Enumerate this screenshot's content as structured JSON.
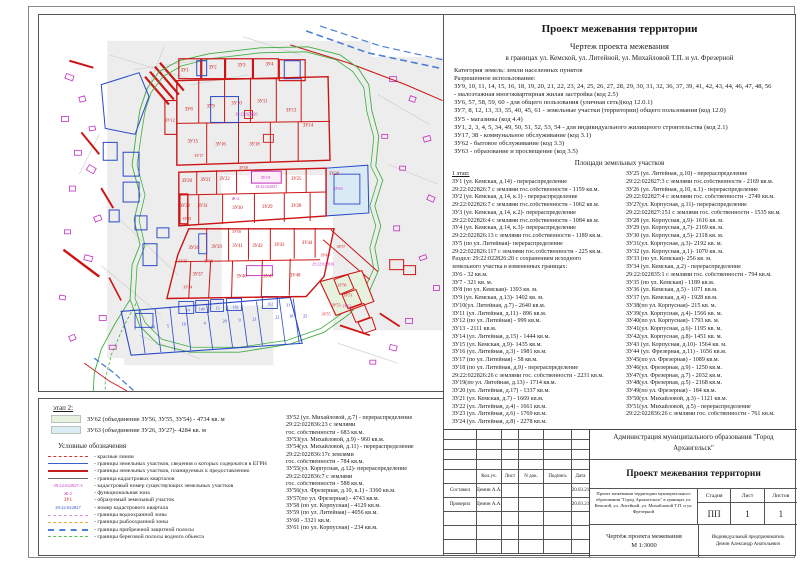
{
  "right_panel": {
    "title": "Проект межевания территории",
    "subtitle": "Чертеж проекта межевания",
    "boundary_line": "в границах ул. Кемской, ул. Литейной, ул. Михайловой Т.П. и ул. Фрезерной",
    "paragraph_lines": [
      "Категория земель: земли населенных пунктов",
      "Разрешенное использование:",
      "ЗУ9, 10, 11, 14, 15, 16, 18, 19, 20, 21, 22, 23, 24, 25, 26, 27, 28, 29, 30, 31, 32, 36, 37, 39, 41, 42, 43, 44, 46, 47, 48, 56",
      "- малоэтажная многоквартирная жилая застройка (код 2.5)",
      "ЗУ6, 57, 58, 59, 60 - для общего пользования (уличная сеть)(код 12.0.1)",
      "ЗУ7, 8, 12, 13, 33, 35, 40, 45, 61 - земельные участки (территории) общего пользования (код 12.0)",
      "ЗУ5 - магазины (код 4.4)",
      "ЗУ1, 2, 3, 4, 5, 34, 49, 50, 51, 52, 53, 54 - для индивидуального жилищного строительства (код 2.1)",
      "ЗУ17, 38 - коммунальное обслуживание (код 3.1)",
      "ЗУ62 - бытовое  обслуживание (код 3.3)",
      "ЗУ63 - образование и просвещение (код 3.5)"
    ],
    "areas_heading": "Площади земельных участков",
    "stage1_label": "1 этап:",
    "areas_col1": [
      "ЗУ1 (ул. Кемская, д.14) - перераспределение",
      "29:22:022826:7 с землями гос.собственности - 1159 кв.м.",
      "ЗУ2 (ул. Кемская, д.14, к.1) - перераспределение",
      "29:22:022826:7 с землями гос.собственности - 1062 кв.м.",
      "ЗУ3 (ул. Кемская, д.14, к.2)- перераспределение",
      "29:22:022826:4 с землями гос.собственности - 1084 кв.м.",
      "ЗУ4 (ул. Кемская, д.14, к.3)- перераспределение",
      "29:22:022826:13 с землями гос.собственности - 1189 кв.м.",
      "ЗУ5 (по ул. Литейная)- перераспределение",
      "29:22:022826:117 с землями гос.собственности - 225 кв.м.",
      "Раздел: 29:22:022826:20 с сохранением исходного",
      "земельного участка в измененных границах:",
      "ЗУ6 - 32 кв.м.",
      "ЗУ7 - 321 кв. м.",
      "ЗУ8 (по ул. Кемская)- 1393 кв. м.",
      "ЗУ9 (ул. Кемская, д.13)- 1402 кв. м.",
      "ЗУ10(ул. Литейная, д.7) - 2640 кв.м.",
      "ЗУ11  (ул. Литейная, д.11) - 896 кв.м.",
      "ЗУ12 (по ул. Литейная) - 999 кв.м.",
      "ЗУ13 - 2111 кв.м.",
      "ЗУ14 (ул. Литейная, д.15) - 1444 кв.м.",
      "ЗУ15 (ул. Кемская, д.9)- 1435 кв.м.",
      "ЗУ16 (ул. Литейная, д.3) - 1981 кв.м.",
      "ЗУ17 (по ул. Литейная) - 58 кв.м.",
      "ЗУ18 (по ул. Литейная, д.9) - перераспределение",
      "29:22:022826:26 с землями гос. собственности - 2231 кв.м.",
      "ЗУ19(по ул. Литейная, д.13) - 1714 кв.м.",
      "ЗУ20 (ул. Литейная, д.17) - 1337 кв.м.",
      "ЗУ21 (ул. Кемская, д.7) - 1669 кв.м.",
      "ЗУ22 (ул. Литейная, д.4) - 1661 кв.м.",
      "ЗУ23 (ул. Литейная, д.6) - 1769 кв.м.",
      "ЗУ24 (ул. Литейная, д.8) - 2278 кв.м."
    ],
    "areas_col2": [
      "ЗУ25 (ул. Литейная, д.10) - перераспределение",
      "29:22:022827:3 с землями гос.собственности - 2169 кв.м.",
      "ЗУ26 (ул. Литейная, д.10, к.1) - перераспределение",
      "29:22:022827:4 с землями гос. собственности - 2749 кв.м.",
      "ЗУ27(ул. Корпусная, д.11)- перераспределение",
      "29:22:022827:151 с землями гос. собственности - 1535 кв.м.",
      "ЗУ28  (ул. Корпусная, д.9)- 1616 кв. м.",
      "ЗУ29 (ул. Корпусная, д.7)- 2169 кв. м.",
      "ЗУ30 (ул. Корпусная, д.5)- 2118 кв. м.",
      "ЗУ31(ул. Корпусная, д.3)- 2192 кв. м.",
      "ЗУ32 (ул. Корпусная, д.1)- 1070 кв. м.",
      "ЗУ33 (по ул. Кемская)- 256 кв. м.",
      "ЗУ34 (ул. Кемская, д.2) - перераспределение",
      "29:22:022835:1 с землями гос. собственности - 794 кв.м.",
      "ЗУ35 (по ул. Кемская) - 1189 кв.м.",
      "ЗУ36 (ул. Кемская, д.5) - 1071 кв.м.",
      "ЗУ37 (ул. Кемская, д.4) - 1928 кв.м.",
      "ЗУ38(по ул. Корпусная)- 215 кв. м.",
      "ЗУ39(ул. Корпусная, д.4)- 1566 кв. м.",
      "ЗУ40(по ул. Корпусная)- 1793 кв. м.",
      "ЗУ41(ул. Корпусная, д.6)- 1195 кв. м.",
      "ЗУ42(ул. Корпусная, д.8)- 1451 кв. м.",
      "ЗУ43 (ул. Корпусная, д.10)- 1564 кв. м.",
      "ЗУ44 (ул. Фрезерная, д.11) - 1656 кв.м.",
      "ЗУ45(по ул. Фрезерная) - 1089 кв.м.",
      "ЗУ46(ул. Фрезерная, д.9) - 1250 кв.м.",
      "ЗУ47(ул. Фрезерная, д.7) - 2032 кв.м.",
      "ЗУ48(ул. Фрезерная, д.5) - 2168 кв.м.",
      "ЗУ49(по ул. Фрезерная) - 184 кв.м.",
      "ЗУ50(ул. Михайловой, д.3) - 1121 кв.м.",
      "ЗУ51(ул. Михайловой, д.5) - перераспределение",
      "29:22:022836:26 с землями гос. собственности - 761 кв.м."
    ]
  },
  "bottom_panel": {
    "stage2_label": "этап 2:",
    "stage2_items": [
      {
        "swatch": "#e7f2de",
        "text": "ЗУ62 (объединение ЗУ56, ЗУ55, ЗУ54) - 4734 кв. м"
      },
      {
        "swatch": "#dcecf4",
        "text": "ЗУ63 (объединение ЗУ26, ЗУ27)- 4284 кв. м"
      }
    ],
    "legend_title": "Условные обозначения",
    "legend": [
      {
        "type": "line",
        "style": "red-dash",
        "label": "- красные линии"
      },
      {
        "type": "line",
        "style": "blue-solid",
        "label": "- границы земельных участков, сведения о которых содержатся в ЕГРН"
      },
      {
        "type": "line",
        "style": "red-thick",
        "label": "- границы земельных участков, планируемых к предоставлению"
      },
      {
        "type": "line",
        "style": "black-thin",
        "label": "- граница кадастровых кварталов"
      },
      {
        "type": "text",
        "style": "m",
        "sample": "29:22:022827:3",
        "label": "- кадастровый номер существующих земельных участков"
      },
      {
        "type": "text",
        "style": "m",
        "sample": "Ж-2",
        "label": "- функциональная зона"
      },
      {
        "type": "text",
        "style": "r",
        "sample": "ЗУ1",
        "label": "- образуемый земельный участок"
      },
      {
        "type": "text",
        "style": "b",
        "sample": "29:22:022827",
        "label": "- номер кадастрового квартала"
      },
      {
        "type": "line",
        "style": "magenta-dash",
        "label": "- границы водоохранной зоны"
      },
      {
        "type": "line",
        "style": "orange-dash",
        "label": "- границы рыбоохранной зоны"
      },
      {
        "type": "line",
        "style": "blue-dash",
        "label": "- границы прибрежной защитной полосы"
      },
      {
        "type": "line",
        "style": "green-dash",
        "label": "- границы береговой полосы водного объекта"
      }
    ],
    "areas_col3": [
      "ЗУ52 (ул. Михайловой, д.7) - перераспределение",
      "29:22:022836:23 с землями",
      "гос. собственности - 683 кв.м.",
      "ЗУ53(ул. Михайловой, д.9) - 960 кв.м.",
      "ЗУ54(ул. Михайловой, д.11) - перераспределение",
      "29:22:022836:17с землями",
      "гос. собственности - 784 кв.м.",
      "ЗУ55(ул. Корпусная, д.12)- перераспределение",
      "29:22:022836:7 с землями",
      "гос. собственности - 588 кв.м.",
      "ЗУ56(ул. Фрезерная, д.10, к.1) - 3360 кв.м.",
      "ЗУ57(по ул. Фрезерная) - 4743 кв.м.",
      "ЗУ58 (по ул. Корпусная) - 4129 кв.м.",
      "ЗУ59 (по ул. Литейная) - 4056 кв.м.",
      "ЗУ60 - 3321 кв.м.",
      "ЗУ61 (по ул. Корпусная) - 234 кв.м."
    ]
  },
  "title_block": {
    "header_cols": [
      "Кол.уч.",
      "Лист",
      "N док.",
      "Подпись",
      "Дата"
    ],
    "rows": [
      {
        "role": "Составил",
        "name": "Демин А.А.",
        "date": "20.03.21"
      },
      {
        "role": "Проверил",
        "name": "Демин А.А.",
        "date": "20.03.21"
      }
    ],
    "org": "Администрация муниципального образования \"Город Архангельск\"",
    "doc_title": "Проект межевания территории",
    "project_desc": "Проект межевания территории муниципального образования \"Город Архангельск\" в границах ул. Кемской, ул. Литейной, ул. Михайловой Т.П. и ул. Фрезерной",
    "stage_label": "Стадия",
    "sheet_label": "Лист",
    "sheets_label": "Листов",
    "stage_value": "ПП",
    "sheet_value": "1",
    "sheets_value": "1",
    "drawing_name": "Чертёж проекта межевания",
    "scale": "М 1:3000",
    "contractor": "Индивидуальный предприниматель",
    "contractor_name": "Демин Александр Анатольевич"
  },
  "map": {
    "colors": {
      "red": "#cc1414",
      "blue": "#2a48c8",
      "magenta": "#c02ec0",
      "green": "#3fae3f",
      "orange": "#e8a23c",
      "grey": "#cfcfcf"
    },
    "labels": [
      {
        "t": "ЗУ1",
        "x": 146,
        "y": 57
      },
      {
        "t": "ЗУ2",
        "x": 174,
        "y": 54
      },
      {
        "t": "ЗУ3",
        "x": 203,
        "y": 52
      },
      {
        "t": "ЗУ4",
        "x": 231,
        "y": 51
      },
      {
        "t": "ЗУ8",
        "x": 150,
        "y": 96
      },
      {
        "t": "ЗУ9",
        "x": 172,
        "y": 93
      },
      {
        "t": "ЗУ10",
        "x": 198,
        "y": 90
      },
      {
        "t": "ЗУ11",
        "x": 224,
        "y": 88
      },
      {
        "t": "ЗУ13",
        "x": 253,
        "y": 97
      },
      {
        "t": "ЗУ14",
        "x": 270,
        "y": 112
      },
      {
        "t": "ЗУ12",
        "x": 131,
        "y": 107,
        "s": 4.4
      },
      {
        "t": "ЗУ15",
        "x": 154,
        "y": 128
      },
      {
        "t": "ЗУ16",
        "x": 182,
        "y": 131
      },
      {
        "t": "ЗУ18",
        "x": 216,
        "y": 131
      },
      {
        "t": "ЗУ17",
        "x": 160,
        "y": 143,
        "s": 4
      },
      {
        "t": "29:22:022826",
        "x": 208,
        "y": 101,
        "c": "m",
        "s": 4
      },
      {
        "t": "ЗУ59",
        "x": 205,
        "y": 155,
        "s": 4
      },
      {
        "t": "ЗУ20",
        "x": 148,
        "y": 168
      },
      {
        "t": "ЗУ21",
        "x": 167,
        "y": 167
      },
      {
        "t": "ЗУ22",
        "x": 186,
        "y": 166
      },
      {
        "t": "ЗУ19",
        "x": 227,
        "y": 165,
        "c": "m",
        "s": 4.4
      },
      {
        "t": "29:22:022827",
        "x": 228,
        "y": 174,
        "c": "m",
        "s": 4
      },
      {
        "t": "ЗУ25",
        "x": 258,
        "y": 166
      },
      {
        "t": "ЗУ26",
        "x": 296,
        "y": 161
      },
      {
        "t": "ЗУ63",
        "x": 300,
        "y": 176,
        "c": "m",
        "s": 4.4
      },
      {
        "t": "Ж-2",
        "x": 197,
        "y": 186,
        "c": "m",
        "s": 4.6
      },
      {
        "t": "ЗУ32",
        "x": 146,
        "y": 193
      },
      {
        "t": "ЗУ31",
        "x": 164,
        "y": 193
      },
      {
        "t": "ЗУ30",
        "x": 199,
        "y": 195
      },
      {
        "t": "ЗУ29",
        "x": 229,
        "y": 194
      },
      {
        "t": "ЗУ28",
        "x": 258,
        "y": 193
      },
      {
        "t": "ЗУ33",
        "x": 148,
        "y": 206,
        "s": 4
      },
      {
        "t": "ЗУ58",
        "x": 198,
        "y": 219,
        "s": 4
      },
      {
        "t": "ЗУ36",
        "x": 155,
        "y": 235
      },
      {
        "t": "ЗУ39",
        "x": 178,
        "y": 234
      },
      {
        "t": "ЗУ41",
        "x": 199,
        "y": 233
      },
      {
        "t": "ЗУ42",
        "x": 219,
        "y": 233
      },
      {
        "t": "ЗУ43",
        "x": 241,
        "y": 232
      },
      {
        "t": "ЗУ44",
        "x": 269,
        "y": 230
      },
      {
        "t": "ЗУ45",
        "x": 287,
        "y": 243,
        "s": 4.2
      },
      {
        "t": "ЗУ35",
        "x": 144,
        "y": 249,
        "s": 4.2
      },
      {
        "t": "ЗУ38",
        "x": 170,
        "y": 249,
        "s": 4.2
      },
      {
        "t": "ЗУ37",
        "x": 159,
        "y": 262
      },
      {
        "t": "ЗУ46",
        "x": 203,
        "y": 264
      },
      {
        "t": "ЗУ47",
        "x": 230,
        "y": 264
      },
      {
        "t": "ЗУ48",
        "x": 257,
        "y": 263
      },
      {
        "t": "ЗУ34",
        "x": 149,
        "y": 275,
        "s": 4.2
      },
      {
        "t": "29:22:022836",
        "x": 285,
        "y": 252,
        "c": "m",
        "s": 4
      },
      {
        "t": "ЗУ57",
        "x": 303,
        "y": 234,
        "s": 4
      },
      {
        "t": "ЗУ50",
        "x": 304,
        "y": 273,
        "s": 4.2
      },
      {
        "t": "ЗУ51",
        "x": 310,
        "y": 283,
        "s": 4.2
      },
      {
        "t": "ЗУ53",
        "x": 298,
        "y": 293,
        "s": 4.2
      },
      {
        "t": "ЗУ55",
        "x": 288,
        "y": 302,
        "s": 4.2
      },
      {
        "t": "ЗУ62",
        "x": 309,
        "y": 294,
        "c": "m",
        "s": 4.2
      },
      {
        "t": "3",
        "x": 96,
        "y": 316,
        "c": "b",
        "s": 4.2
      },
      {
        "t": "13",
        "x": 114,
        "y": 315,
        "c": "b",
        "s": 4.2
      },
      {
        "t": "5",
        "x": 129,
        "y": 314,
        "c": "b",
        "s": 4.2
      },
      {
        "t": "16",
        "x": 145,
        "y": 312,
        "c": "b",
        "s": 4.2
      },
      {
        "t": "4",
        "x": 166,
        "y": 311,
        "c": "b",
        "s": 4.2
      },
      {
        "t": "20",
        "x": 186,
        "y": 309,
        "c": "b",
        "s": 4.2
      },
      {
        "t": "9",
        "x": 201,
        "y": 308,
        "c": "b",
        "s": 4.2
      },
      {
        "t": "21",
        "x": 216,
        "y": 307,
        "c": "b",
        "s": 4.2
      },
      {
        "t": "22",
        "x": 239,
        "y": 305,
        "c": "b",
        "s": 4.2
      },
      {
        "t": "18",
        "x": 253,
        "y": 304,
        "c": "b",
        "s": 4.2
      },
      {
        "t": "25",
        "x": 267,
        "y": 304,
        "c": "b",
        "s": 4.2
      },
      {
        "t": "31",
        "x": 250,
        "y": 293,
        "c": "b",
        "s": 4.2
      },
      {
        "t": "163",
        "x": 197,
        "y": 295,
        "c": "b",
        "s": 3.8
      },
      {
        "t": "162",
        "x": 232,
        "y": 292,
        "c": "b",
        "s": 3.8
      },
      {
        "t": "13",
        "x": 179,
        "y": 296,
        "c": "b",
        "s": 3.8
      },
      {
        "t": "140",
        "x": 163,
        "y": 297,
        "c": "b",
        "s": 3.8
      },
      {
        "t": "14",
        "x": 149,
        "y": 298,
        "c": "b",
        "s": 3.8
      }
    ]
  }
}
